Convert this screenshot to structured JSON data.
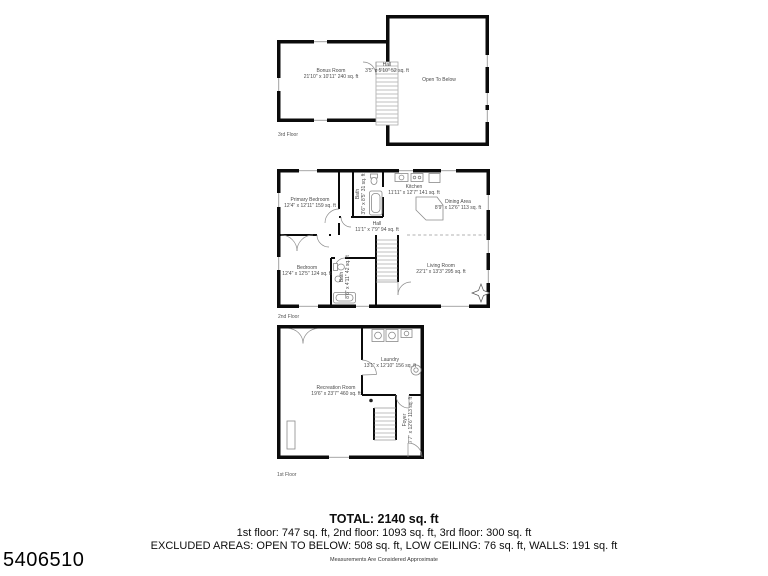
{
  "meta": {
    "listing_id": "5406510",
    "disclaimer": "Measurements Are Considered Approximate"
  },
  "summary": {
    "total": "TOTAL: 2140 sq. ft",
    "by_floor": "1st floor: 747 sq. ft, 2nd floor: 1093 sq. ft, 3rd floor: 300 sq. ft",
    "excluded": "EXCLUDED AREAS: OPEN TO BELOW: 508 sq. ft, LOW CEILING: 76 sq. ft, WALLS: 191 sq. ft"
  },
  "floors": {
    "third": {
      "label": "3rd Floor",
      "rooms": {
        "bonus_room": {
          "name": "Bonus Room",
          "dims": "21'10\" x 10'11\" 240 sq. ft"
        },
        "hall": {
          "name": "Hall",
          "dims": "3'5\" x 5'10\" 52 sq. ft"
        },
        "open_to_below": {
          "name": "Open To Below"
        }
      }
    },
    "second": {
      "label": "2nd Floor",
      "rooms": {
        "primary_bedroom": {
          "name": "Primary Bedroom",
          "dims": "12'4\" x 12'11\" 159 sq. ft"
        },
        "bath_upper": {
          "name": "Bath",
          "dims": "3'6\" x 8'5\" 31 sq. ft"
        },
        "kitchen": {
          "name": "Kitchen",
          "dims": "11'11\" x 12'7\" 141 sq. ft"
        },
        "dining_area": {
          "name": "Dining Area",
          "dims": "8'9\" x 12'6\" 113 sq. ft"
        },
        "hall": {
          "name": "Hall",
          "dims": "11'1\" x 7'9\" 94 sq. ft"
        },
        "bedroom": {
          "name": "Bedroom",
          "dims": "12'4\" x 12'5\" 124 sq. ft"
        },
        "bath_lower": {
          "name": "Bath",
          "dims": "8'6\" x 4'11\" 42 sq. ft"
        },
        "living_room": {
          "name": "Living Room",
          "dims": "22'1\" x 13'3\" 295 sq. ft"
        }
      }
    },
    "first": {
      "label": "1st Floor",
      "rooms": {
        "recreation_room": {
          "name": "Recreation Room",
          "dims": "19'6\" x 23'7\" 460 sq. ft"
        },
        "laundry": {
          "name": "Laundry",
          "dims": "13'1\" x 12'10\" 156 sq. ft"
        },
        "foyer": {
          "name": "Foyer",
          "dims": "7'7\" x 12'6\" 113 sq. ft"
        }
      }
    }
  },
  "colors": {
    "wall": "#0b0b0b",
    "fixture": "#8a8a8a",
    "label_text": "#4a4a4a",
    "body_text": "#111111"
  }
}
